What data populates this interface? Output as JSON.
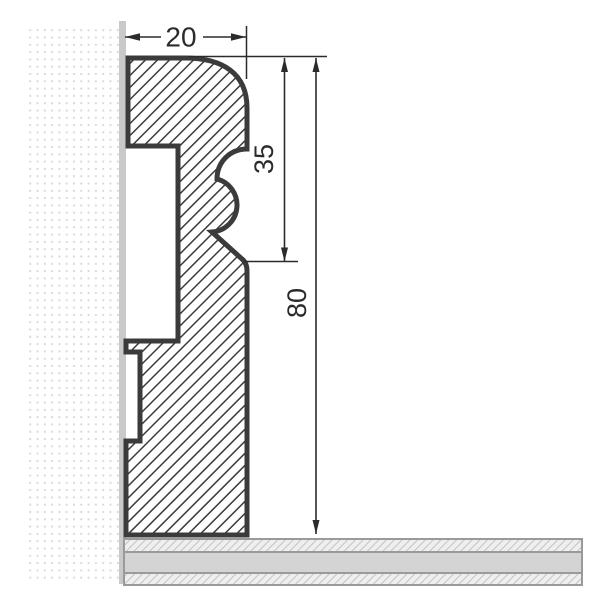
{
  "drawing": {
    "dimensions": {
      "width": "20",
      "profile_height": "35",
      "total_height": "80"
    },
    "colors": {
      "background": "#ffffff",
      "outline": "#3b3b3b",
      "dimension": "#2b2b2b",
      "wall_surface": "#c9c9c9",
      "wall_dot": "#dadada",
      "floor_fill": "#d4d4d4",
      "floor_hatch": "#c6c6c6",
      "floor_border": "#9a9a9a"
    }
  }
}
